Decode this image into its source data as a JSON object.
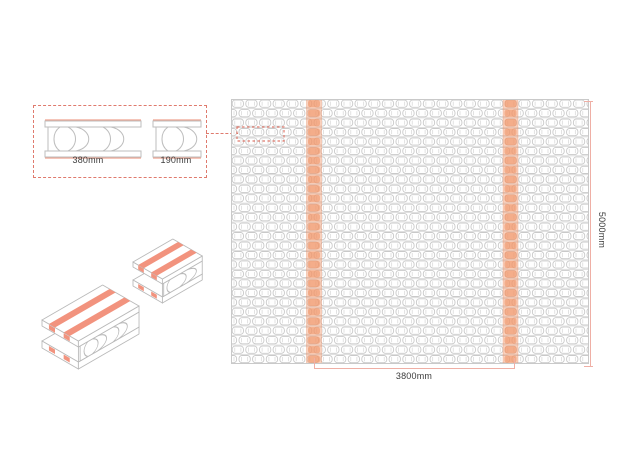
{
  "drawing": {
    "type": "hollow-core-slab-technical-drawing",
    "detail": {
      "sections": [
        {
          "name": "section-380",
          "label": "380mm"
        },
        {
          "name": "section-190",
          "label": "190mm"
        }
      ]
    },
    "plan": {
      "width_dimension": "3800mm",
      "height_dimension": "5000mm"
    }
  },
  "colors": {
    "accent": "#F2937E",
    "accent_line": "#EFA28F",
    "stripe_fill": "rgba(243,164,126,0.50)",
    "stripe_cell": "rgba(240,148,104,0.60)",
    "dimension_line": "#EFAFA5",
    "callout": "#DF7A6D",
    "outline": "#BDBDBD",
    "pattern": "#C9C9C9",
    "pattern_light": "#D6D6D6",
    "text": "#3C3C3C"
  }
}
